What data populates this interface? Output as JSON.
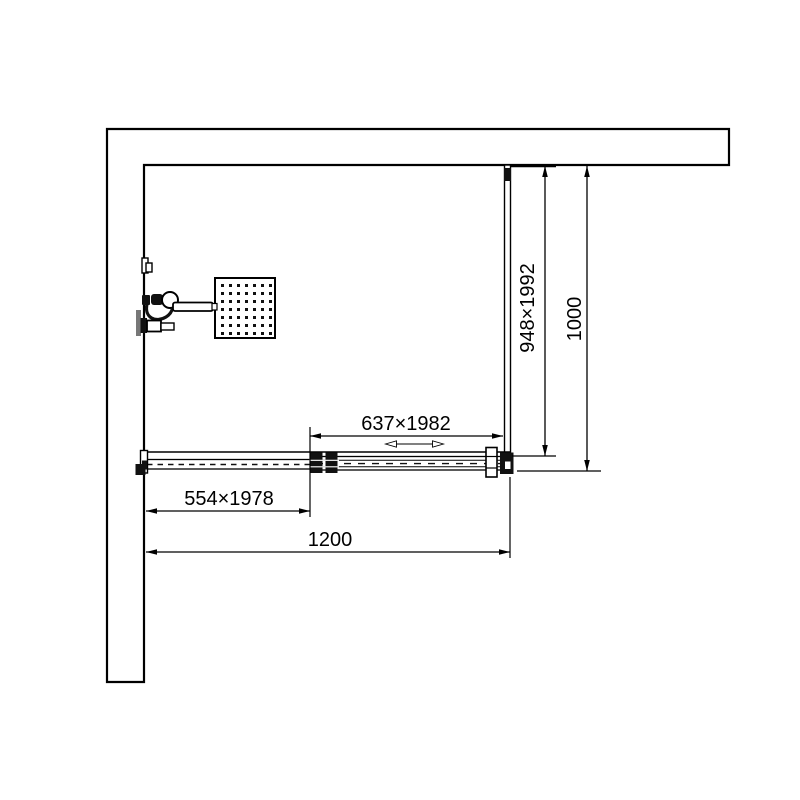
{
  "dimensions": {
    "side_panel": "948×1992",
    "side_overall": "1000",
    "sliding_door": "637×1982",
    "fixed_panel": "554×1978",
    "front_overall": "1200"
  },
  "colors": {
    "line": "#000000",
    "background": "#ffffff",
    "dark_fill": "#111111",
    "gray_fill": "#777777"
  }
}
